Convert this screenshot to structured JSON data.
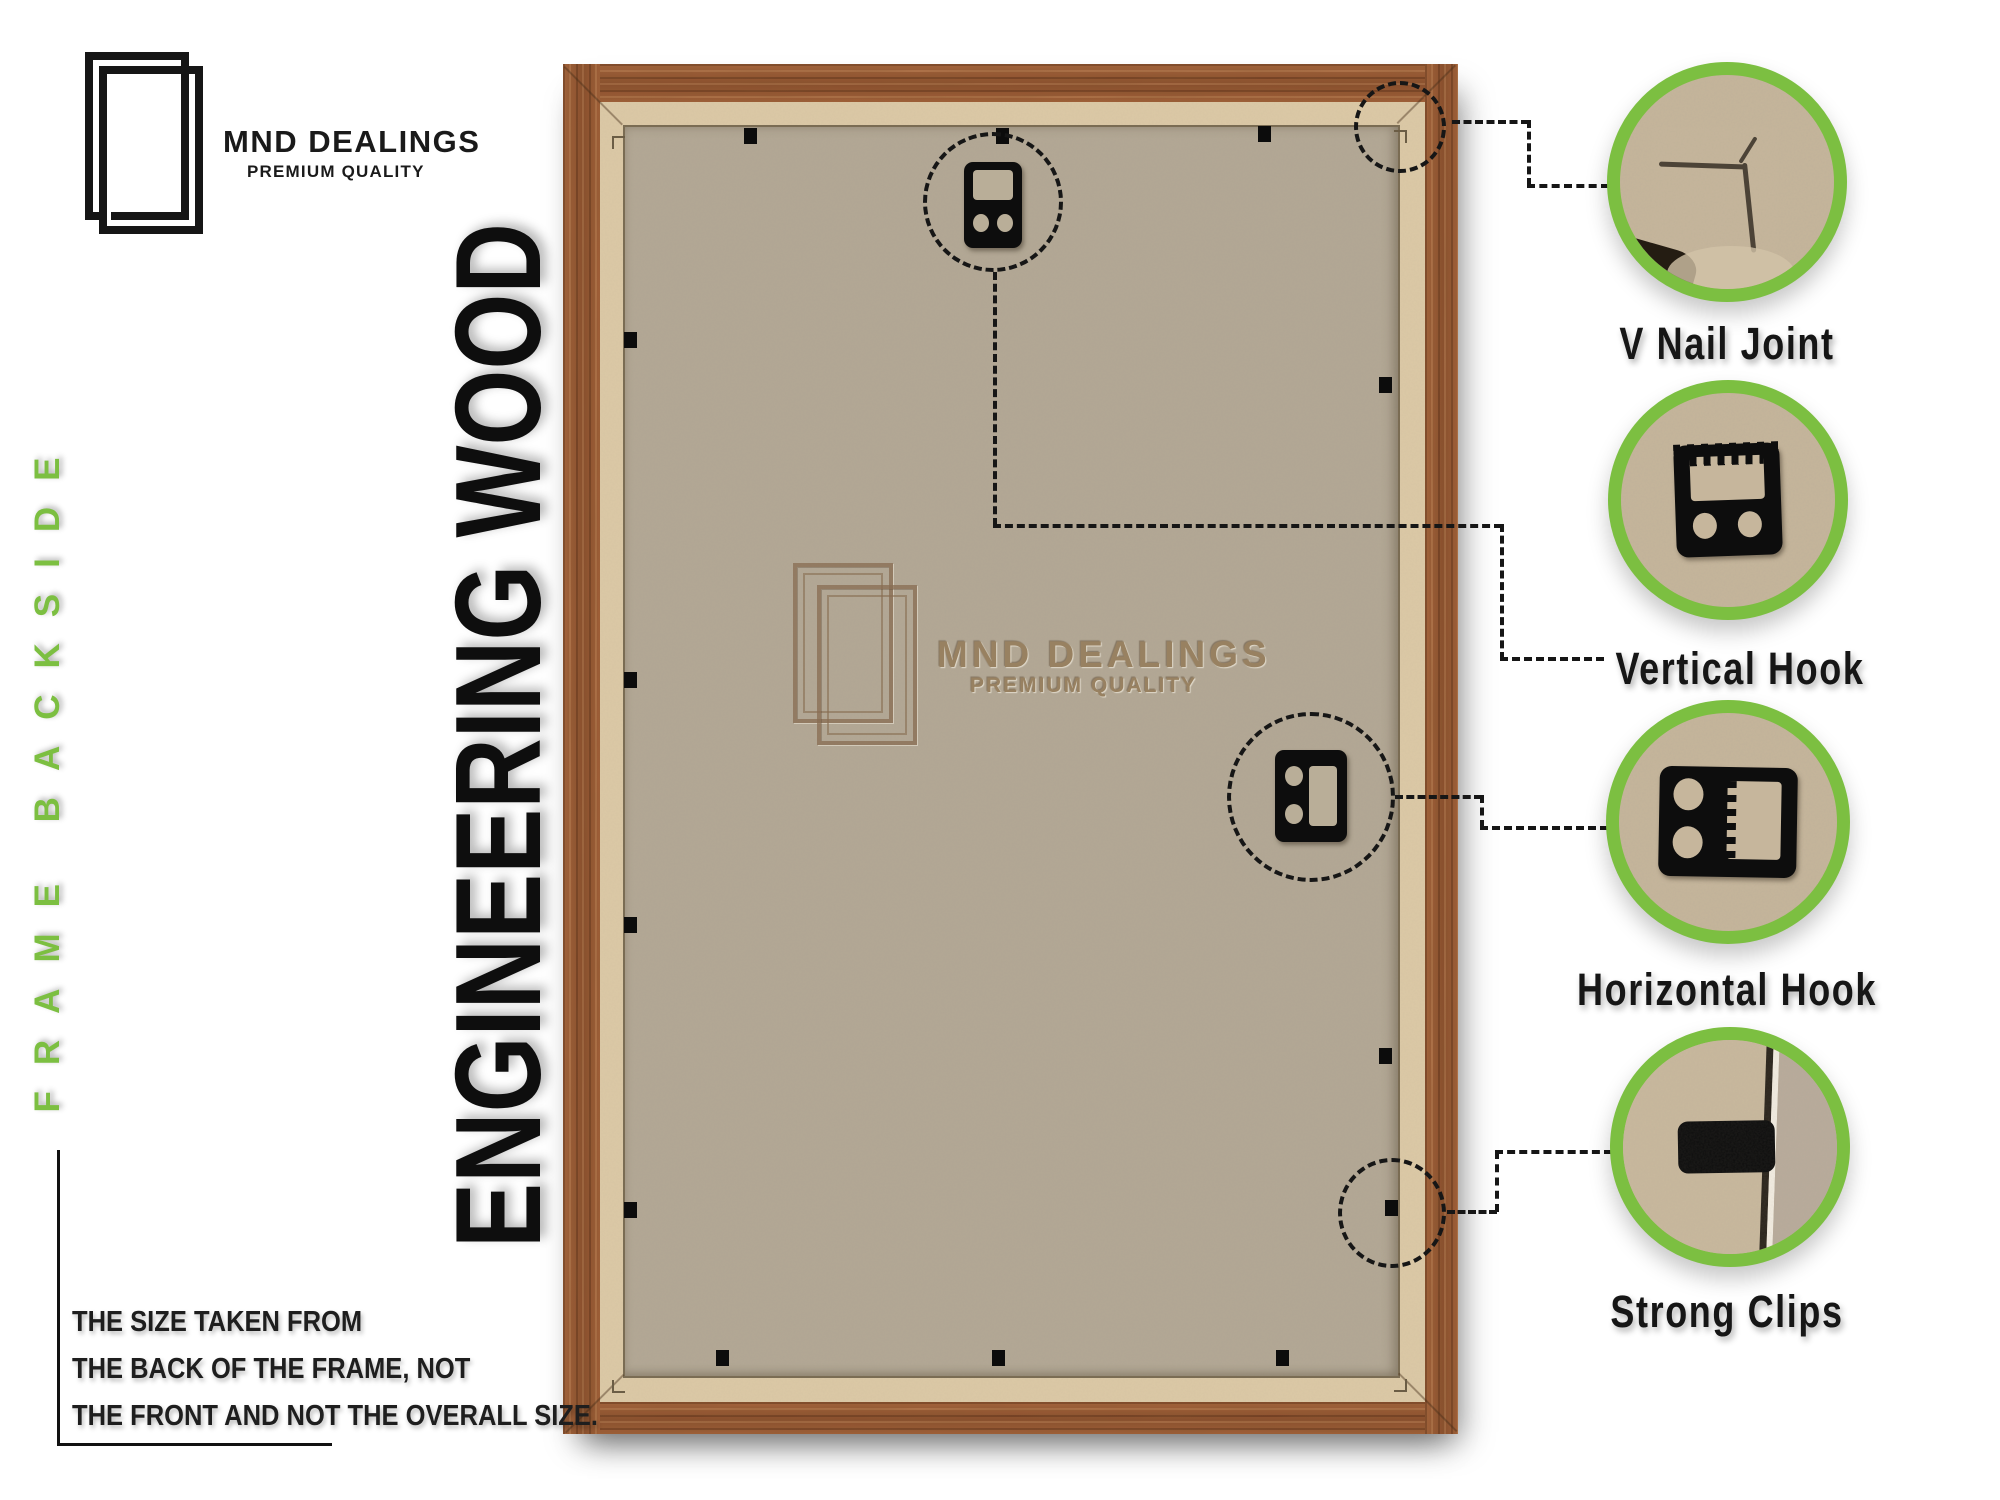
{
  "brand": {
    "name": "MND DEALINGS",
    "tagline": "PREMIUM QUALITY"
  },
  "labels": {
    "side_vertical": "FRAME  BACKSIDE",
    "material_vertical": "ENGINEERING WOOD"
  },
  "watermark": {
    "name": "MND DEALINGS",
    "tagline": "PREMIUM QUALITY"
  },
  "note": {
    "lines": [
      "THE SIZE TAKEN FROM",
      "THE BACK OF THE FRAME, NOT",
      "THE FRONT AND NOT THE OVERALL SIZE."
    ]
  },
  "callouts": [
    {
      "id": "v-nail-joint",
      "label": "V Nail Joint"
    },
    {
      "id": "vertical-hook",
      "label": "Vertical Hook"
    },
    {
      "id": "horizontal-hook",
      "label": "Horizontal Hook"
    },
    {
      "id": "strong-clips",
      "label": "Strong Clips"
    }
  ],
  "colors": {
    "accent_green": "#7cbf41",
    "wood_base": "#9c5b36",
    "mdf_panel": "#b3a895",
    "frame_lip": "#dcc9a6",
    "annotation_black": "#161616",
    "watermark_brown": "#97805f"
  }
}
